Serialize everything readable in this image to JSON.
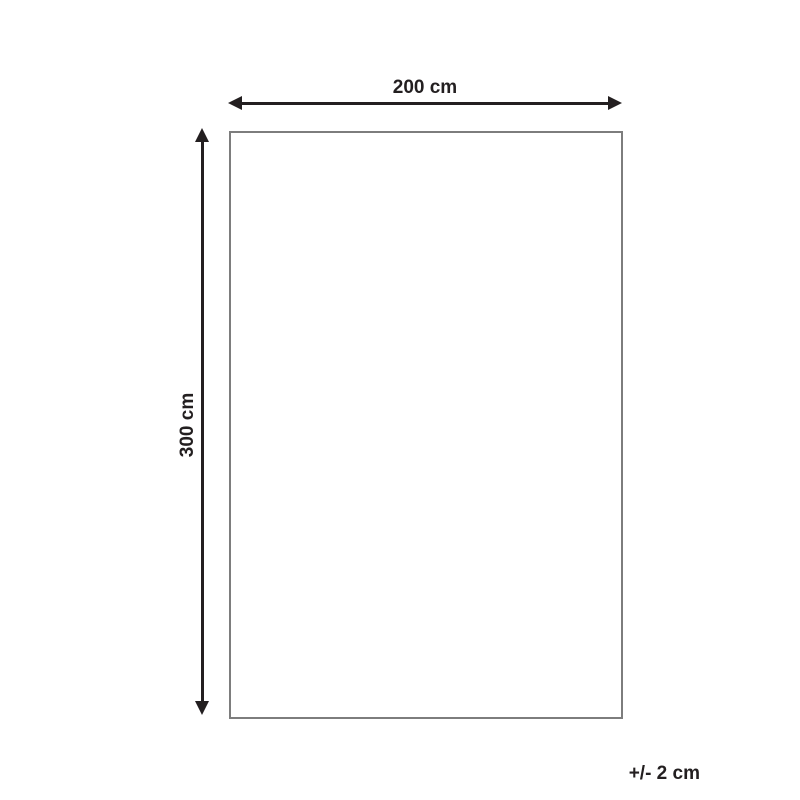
{
  "diagram": {
    "width_label": "200 cm",
    "height_label": "300 cm",
    "tolerance_label": "+/- 2 cm",
    "colors": {
      "arrow": "#231f20",
      "outline": "#7d7d7d",
      "background": "#ffffff",
      "text": "#231f20"
    }
  }
}
